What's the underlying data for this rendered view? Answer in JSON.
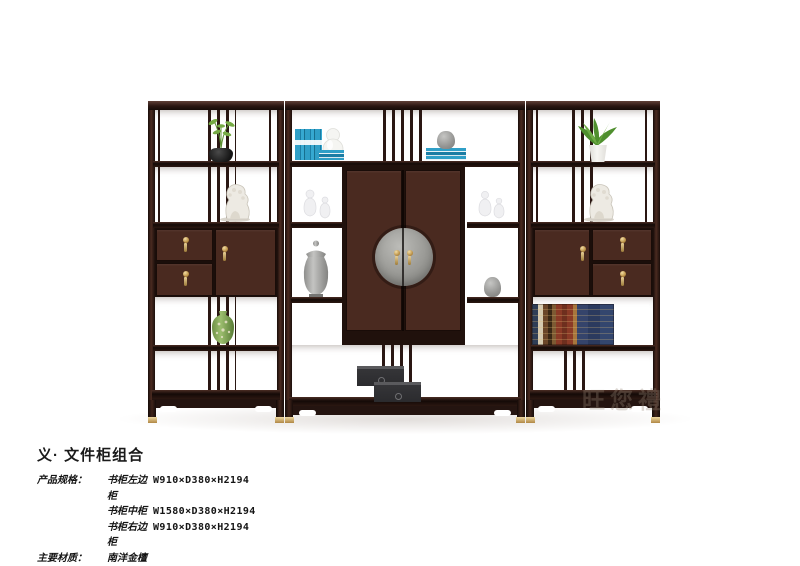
{
  "product": {
    "title": "义· 文件柜组合",
    "specs_label": "产品规格：",
    "specs": [
      {
        "name": "书柜左边柜",
        "dims": "W910×D380×H2194"
      },
      {
        "name": "书柜中柜",
        "dims": "W1580×D380×H2194"
      },
      {
        "name": "书柜右边柜",
        "dims": "W910×D380×H2194"
      }
    ],
    "material_label": "主要材质：",
    "material_value": "南洋金檀"
  },
  "watermark": "旺您禮",
  "colors": {
    "background": "#ffffff",
    "wood_frame": "#2b1712",
    "wood_panel": "#4e2b21",
    "brass": "#c9a159",
    "book_blue": "#2f9fc7",
    "medallion_gray": "#9a9a96",
    "text": "#141414"
  },
  "furniture": {
    "type": "three-unit bookcase / file cabinet combination",
    "decor_items": [
      "black-pot-plant",
      "white-lion-statue-left",
      "blue-books-vertical",
      "white-gourd-vase",
      "blue-books-stack",
      "gray-jar-on-books",
      "white-glass-vases-left",
      "white-glass-vases-right",
      "gray-temple-jar",
      "small-gray-vase",
      "green-porcelain-vase",
      "black-gift-boxes",
      "leather-and-blue-books",
      "green-plant-white-pot",
      "white-lion-statue-right"
    ]
  }
}
